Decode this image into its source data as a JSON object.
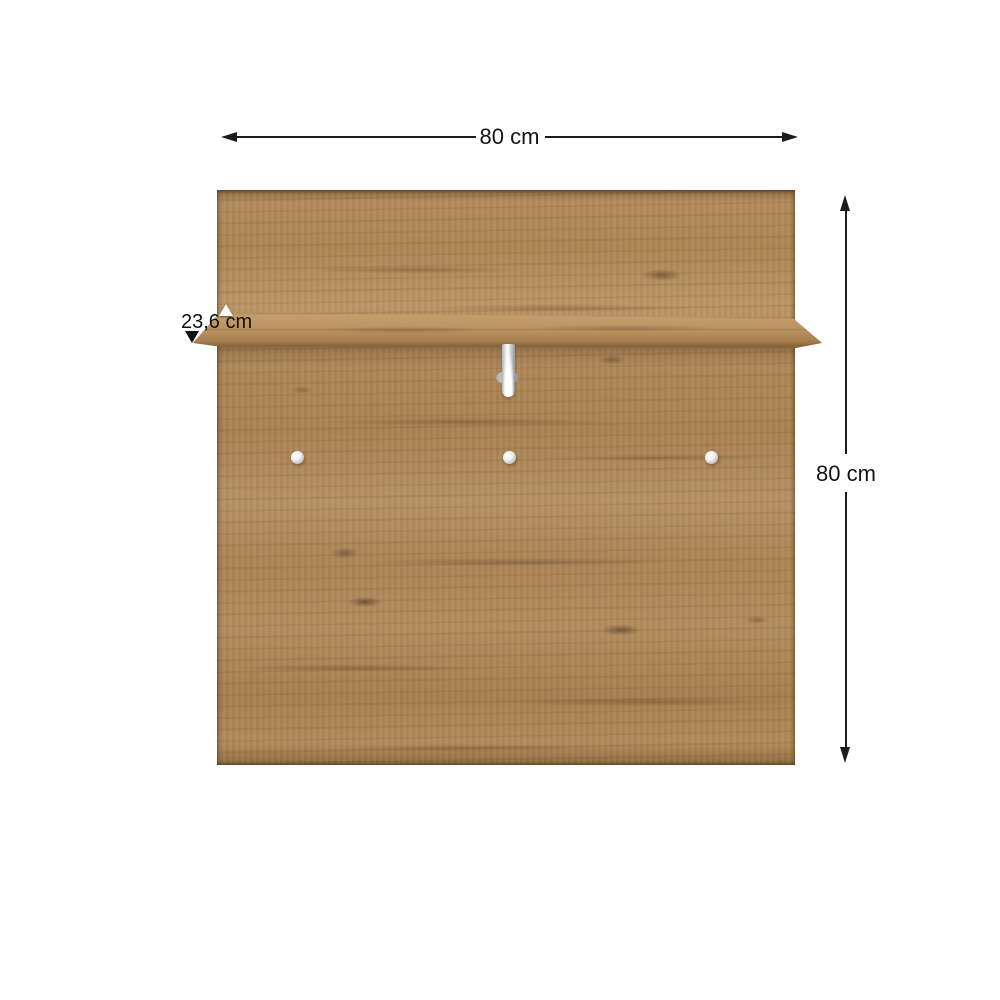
{
  "scene": {
    "type": "product-dimension-diagram",
    "background_color": "#ffffff",
    "product": "Wall-mounted wooden hanger panel with shelf, centre coat hook and three knob hooks"
  },
  "annotations": {
    "width": {
      "label": "80 cm"
    },
    "height": {
      "label": "80 cm"
    },
    "shelf_depth": {
      "label": "23,6 cm"
    },
    "line_color": "#1c1c1c",
    "text_color": "#151515"
  },
  "materials": {
    "wood_base": "#b18b5b",
    "wood_light": "#c49e70",
    "wood_dark": "#7d5c35",
    "wood_knot": "#5f4426",
    "metal_light": "#f5f5f5",
    "metal_dark": "#969696"
  },
  "hardware": {
    "centre_hook_count": 1,
    "knob_count": 3
  }
}
